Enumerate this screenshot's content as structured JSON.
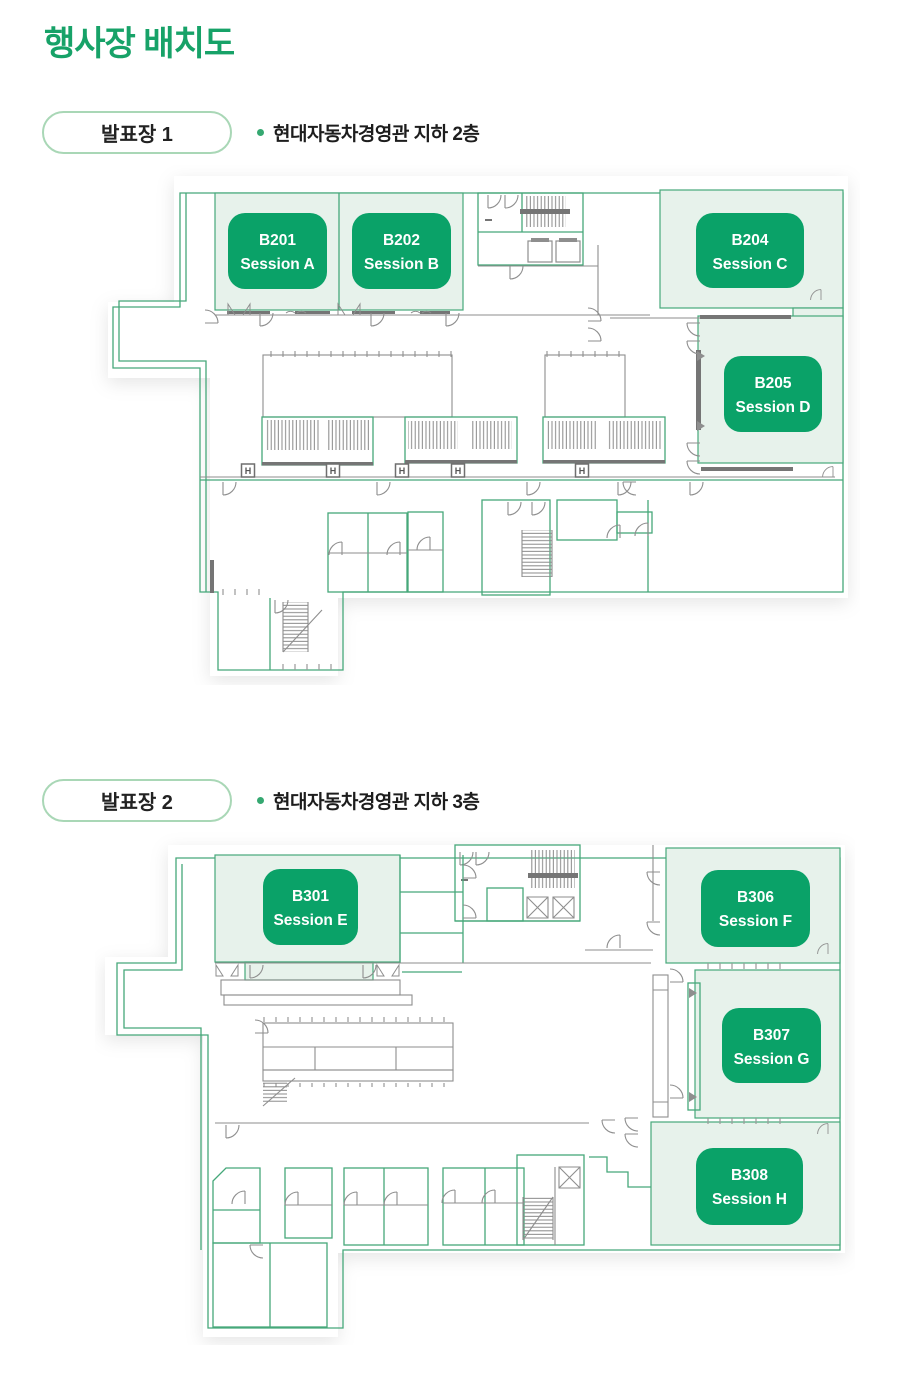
{
  "page": {
    "title": "행사장 배치도"
  },
  "colors": {
    "accent_green": "#17a268",
    "badge_green": "#0aa268",
    "room_highlight": "#e7f2eb",
    "plan_outline_green": "#46a87a",
    "plan_wall_gray": "#8e8e8e",
    "pill_border": "#a9d7b6"
  },
  "sections": [
    {
      "pill": "발표장 1",
      "location": "현대자동차경영관 지하 2층",
      "wall_marker": "H",
      "rooms": [
        {
          "code": "B201",
          "session": "Session A"
        },
        {
          "code": "B202",
          "session": "Session B"
        },
        {
          "code": "B204",
          "session": "Session C"
        },
        {
          "code": "B205",
          "session": "Session D"
        }
      ]
    },
    {
      "pill": "발표장 2",
      "location": "현대자동차경영관 지하 3층",
      "rooms": [
        {
          "code": "B301",
          "session": "Session E"
        },
        {
          "code": "B306",
          "session": "Session F"
        },
        {
          "code": "B307",
          "session": "Session G"
        },
        {
          "code": "B308",
          "session": "Session H"
        }
      ]
    }
  ]
}
